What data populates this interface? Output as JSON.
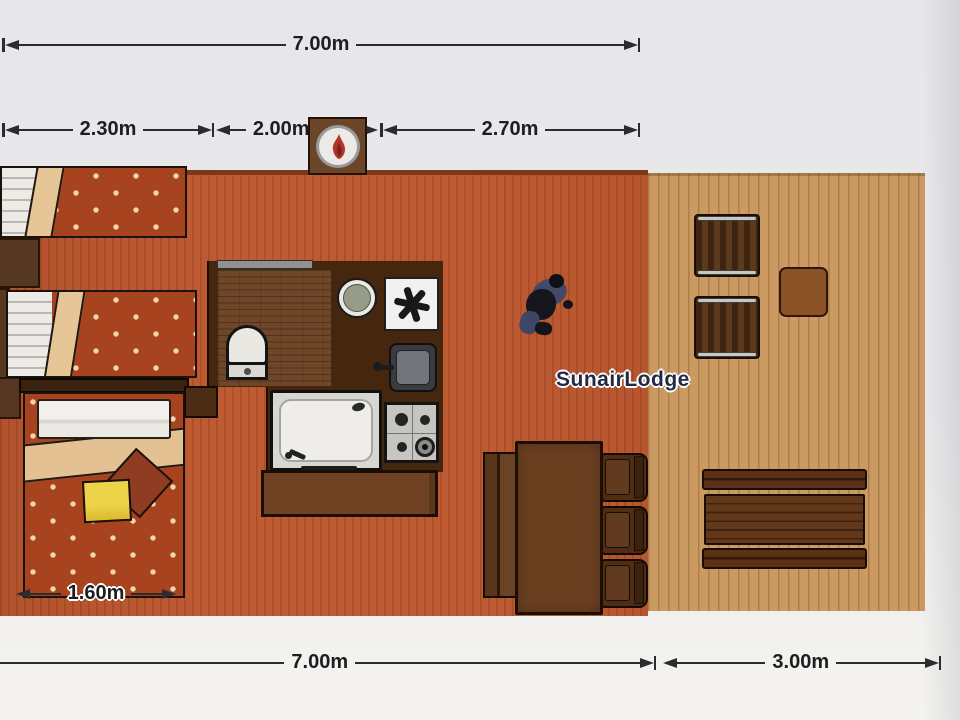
{
  "plan": {
    "lodge_name": "SunairLodge",
    "dimensions": {
      "top_total": "7.00m",
      "top_seg_left": "2.30m",
      "top_seg_mid": "2.00m",
      "top_seg_right": "2.70m",
      "bed_width": "1.60m",
      "bottom_lodge": "7.00m",
      "bottom_deck": "3.00m"
    },
    "colors": {
      "interior_floor": "#bf5b33",
      "deck_floor": "#cb9a63",
      "wet_unit_wall": "#45260f",
      "bedspread": "#a8431f",
      "blanket": "#e6c697",
      "accent_pillow_yellow": "#ecd34a",
      "dimension_line": "#2c2c2e",
      "lodge_label_text": "#232a46",
      "paper_background": "#e9e8ea"
    },
    "icons": {
      "flame_icon": "gas heater flame",
      "fan_icon": "six-spoke extractor asterisk"
    }
  }
}
